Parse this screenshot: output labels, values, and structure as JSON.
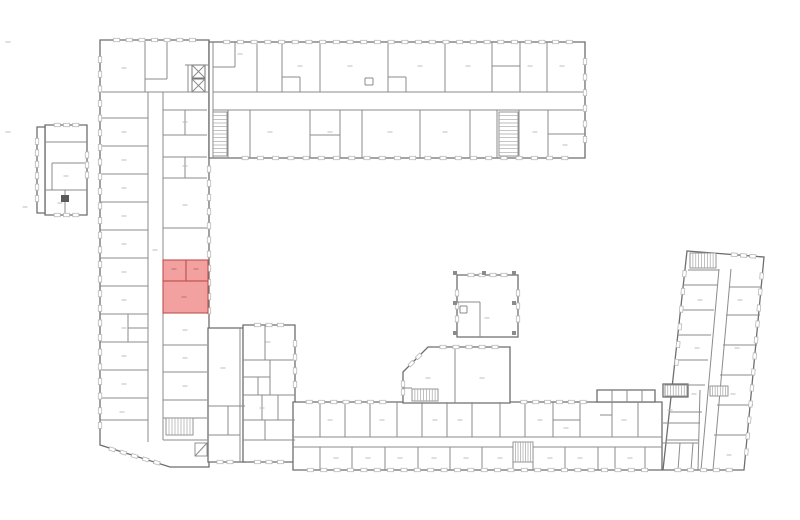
{
  "meta": {
    "title": "building-floor-plan",
    "canvas": {
      "w": 800,
      "h": 520,
      "bg": "#ffffff"
    }
  },
  "style": {
    "wall_color": "#8b8b8b",
    "outline_color": "#6e6e6e",
    "window_color": "#b9b9b9",
    "highlight_fill": "#f2a0a0",
    "highlight_stroke": "#c0504d",
    "highlight_mark": "#bb6f6f",
    "micro_label_color": "#bcbcbc"
  },
  "plan": {
    "outlines": [
      {
        "name": "left-wing",
        "points": "100,40 209,40 209,467 170,467 100,445"
      },
      {
        "name": "corner-block",
        "points": "208,328 245,328 245,462 208,462"
      },
      {
        "name": "south-annex",
        "points": "243,325 295,325 295,462 243,462"
      },
      {
        "name": "top-wing",
        "points": "209,42 585,42 585,158 209,158"
      },
      {
        "name": "bottom-wing",
        "points": "293,402 662,402 662,470 293,470"
      },
      {
        "name": "bottom-wing-roof-row",
        "points": "597,390 655,390 655,402 597,402"
      },
      {
        "name": "courtyard-pavilion",
        "points": "457,275 518,275 518,337 457,337"
      },
      {
        "name": "courtyard-mid-block",
        "points": "403,372 428,347 510,347 510,403 403,403"
      },
      {
        "name": "right-wing",
        "points": "687,251 764,257 744,470 663,470"
      },
      {
        "name": "right-wing-protrusion",
        "points": "663,384 688,384 688,397 663,397"
      },
      {
        "name": "detached-building-main",
        "points": "45,125 87,125 87,215 45,215"
      },
      {
        "name": "detached-building-strip",
        "points": "37,127 45,127 45,213 37,213"
      }
    ],
    "walls": [
      [
        148,
        92,
        148,
        442
      ],
      [
        163,
        92,
        163,
        440
      ],
      [
        100,
        92,
        209,
        92
      ],
      [
        145,
        41,
        145,
        92
      ],
      [
        167,
        41,
        167,
        79
      ],
      [
        145,
        79,
        167,
        79
      ],
      [
        185,
        65,
        209,
        65
      ],
      [
        188,
        65,
        188,
        92
      ],
      [
        100,
        118,
        148,
        118
      ],
      [
        100,
        146,
        148,
        146
      ],
      [
        100,
        174,
        148,
        174
      ],
      [
        100,
        202,
        148,
        202
      ],
      [
        100,
        230,
        148,
        230
      ],
      [
        100,
        258,
        148,
        258
      ],
      [
        100,
        286,
        148,
        286
      ],
      [
        100,
        314,
        148,
        314
      ],
      [
        100,
        342,
        148,
        342
      ],
      [
        100,
        370,
        148,
        370
      ],
      [
        100,
        398,
        148,
        398
      ],
      [
        100,
        420,
        148,
        420
      ],
      [
        128,
        314,
        128,
        342
      ],
      [
        128,
        328,
        148,
        328
      ],
      [
        163,
        110,
        207,
        110
      ],
      [
        163,
        135,
        207,
        135
      ],
      [
        163,
        157,
        207,
        157
      ],
      [
        163,
        178,
        207,
        178
      ],
      [
        163,
        228,
        207,
        228
      ],
      [
        163,
        345,
        207,
        345
      ],
      [
        163,
        372,
        207,
        372
      ],
      [
        163,
        400,
        207,
        400
      ],
      [
        163,
        418,
        207,
        418
      ],
      [
        163,
        440,
        207,
        440
      ],
      [
        185,
        110,
        185,
        135
      ],
      [
        185,
        157,
        185,
        178
      ],
      [
        208,
        406,
        245,
        406
      ],
      [
        240,
        328,
        240,
        462
      ],
      [
        208,
        435,
        240,
        435
      ],
      [
        228,
        406,
        228,
        435
      ],
      [
        243,
        360,
        295,
        360
      ],
      [
        265,
        325,
        265,
        360
      ],
      [
        243,
        377,
        270,
        377
      ],
      [
        270,
        360,
        270,
        395
      ],
      [
        243,
        395,
        295,
        395
      ],
      [
        258,
        377,
        258,
        395
      ],
      [
        243,
        420,
        295,
        420
      ],
      [
        262,
        395,
        262,
        420
      ],
      [
        278,
        395,
        278,
        420
      ],
      [
        243,
        440,
        295,
        440
      ],
      [
        265,
        420,
        265,
        440
      ],
      [
        213,
        92,
        585,
        92
      ],
      [
        213,
        110,
        585,
        110
      ],
      [
        213,
        42,
        213,
        158
      ],
      [
        235,
        42,
        235,
        67
      ],
      [
        213,
        67,
        235,
        67
      ],
      [
        257,
        42,
        257,
        92
      ],
      [
        282,
        42,
        282,
        92
      ],
      [
        320,
        42,
        320,
        92
      ],
      [
        388,
        42,
        388,
        92
      ],
      [
        445,
        42,
        445,
        92
      ],
      [
        492,
        42,
        492,
        92
      ],
      [
        520,
        42,
        520,
        92
      ],
      [
        547,
        42,
        547,
        92
      ],
      [
        282,
        77,
        300,
        77
      ],
      [
        300,
        77,
        300,
        92
      ],
      [
        388,
        77,
        406,
        77
      ],
      [
        406,
        77,
        406,
        92
      ],
      [
        365,
        78,
        373,
        78
      ],
      [
        365,
        78,
        365,
        85
      ],
      [
        365,
        85,
        373,
        85
      ],
      [
        373,
        78,
        373,
        85
      ],
      [
        492,
        66,
        520,
        66
      ],
      [
        228,
        110,
        228,
        158
      ],
      [
        250,
        110,
        250,
        158
      ],
      [
        310,
        110,
        310,
        158
      ],
      [
        340,
        110,
        340,
        158
      ],
      [
        362,
        110,
        362,
        158
      ],
      [
        420,
        110,
        420,
        158
      ],
      [
        470,
        110,
        470,
        158
      ],
      [
        497,
        110,
        497,
        158
      ],
      [
        519,
        110,
        519,
        158
      ],
      [
        548,
        110,
        548,
        158
      ],
      [
        310,
        135,
        340,
        135
      ],
      [
        548,
        134,
        585,
        134
      ],
      [
        293,
        437,
        662,
        437
      ],
      [
        293,
        447,
        662,
        447
      ],
      [
        320,
        402,
        320,
        437
      ],
      [
        345,
        402,
        345,
        437
      ],
      [
        370,
        402,
        370,
        437
      ],
      [
        397,
        402,
        397,
        437
      ],
      [
        422,
        402,
        422,
        437
      ],
      [
        447,
        402,
        447,
        437
      ],
      [
        472,
        402,
        472,
        437
      ],
      [
        500,
        402,
        500,
        437
      ],
      [
        525,
        402,
        525,
        437
      ],
      [
        553,
        402,
        553,
        437
      ],
      [
        580,
        402,
        580,
        437
      ],
      [
        612,
        402,
        612,
        437
      ],
      [
        638,
        402,
        638,
        437
      ],
      [
        553,
        420,
        580,
        420
      ],
      [
        600,
        415,
        612,
        415
      ],
      [
        320,
        447,
        320,
        470
      ],
      [
        352,
        447,
        352,
        470
      ],
      [
        385,
        447,
        385,
        470
      ],
      [
        418,
        447,
        418,
        470
      ],
      [
        450,
        447,
        450,
        470
      ],
      [
        482,
        447,
        482,
        470
      ],
      [
        513,
        447,
        513,
        470
      ],
      [
        533,
        447,
        533,
        470
      ],
      [
        565,
        447,
        565,
        470
      ],
      [
        598,
        447,
        598,
        470
      ],
      [
        615,
        447,
        615,
        470
      ],
      [
        645,
        447,
        645,
        470
      ],
      [
        612,
        390,
        612,
        402
      ],
      [
        627,
        390,
        627,
        402
      ],
      [
        642,
        390,
        642,
        402
      ],
      [
        480,
        302,
        480,
        337
      ],
      [
        457,
        302,
        480,
        302
      ],
      [
        460,
        306,
        467,
        306
      ],
      [
        467,
        306,
        467,
        313
      ],
      [
        460,
        313,
        467,
        313
      ],
      [
        460,
        306,
        460,
        313
      ],
      [
        455,
        347,
        455,
        403
      ],
      [
        403,
        388,
        412,
        388
      ],
      [
        719,
        269,
        701,
        470
      ],
      [
        731,
        269,
        713,
        470
      ],
      [
        688,
        270,
        719,
        270
      ],
      [
        683,
        285,
        717,
        285
      ],
      [
        681,
        310,
        714,
        310
      ],
      [
        678,
        335,
        711,
        335
      ],
      [
        675,
        360,
        708,
        360
      ],
      [
        672,
        385,
        705,
        385
      ],
      [
        669,
        412,
        702,
        412
      ],
      [
        666,
        440,
        699,
        440
      ],
      [
        729,
        287,
        762,
        287
      ],
      [
        726,
        315,
        760,
        315
      ],
      [
        723,
        345,
        757,
        345
      ],
      [
        720,
        375,
        755,
        375
      ],
      [
        717,
        405,
        753,
        405
      ],
      [
        714,
        435,
        750,
        435
      ],
      [
        700,
        390,
        698,
        470
      ],
      [
        663,
        423,
        700,
        423
      ],
      [
        662,
        443,
        698,
        443
      ],
      [
        680,
        443,
        678,
        470
      ],
      [
        693,
        443,
        691,
        470
      ],
      [
        45,
        142,
        87,
        142
      ],
      [
        52,
        163,
        87,
        163
      ],
      [
        52,
        163,
        52,
        190
      ],
      [
        45,
        190,
        87,
        190
      ],
      [
        65,
        190,
        65,
        215
      ]
    ],
    "windows": [
      [
        100,
        45,
        100,
        440,
        26
      ],
      [
        101,
        446,
        168,
        466,
        5
      ],
      [
        209,
        155,
        209,
        325,
        11
      ],
      [
        104,
        40,
        205,
        40,
        7
      ],
      [
        213,
        42,
        583,
        42,
        26
      ],
      [
        230,
        158,
        580,
        158,
        22
      ],
      [
        585,
        46,
        585,
        155,
        6
      ],
      [
        297,
        470,
        658,
        470,
        26
      ],
      [
        297,
        402,
        395,
        402,
        7
      ],
      [
        512,
        402,
        595,
        402,
        6
      ],
      [
        246,
        325,
        292,
        325,
        3
      ],
      [
        295,
        330,
        295,
        398,
        4
      ],
      [
        246,
        462,
        292,
        462,
        3
      ],
      [
        210,
        462,
        240,
        462,
        2
      ],
      [
        460,
        275,
        515,
        275,
        4
      ],
      [
        457,
        280,
        457,
        332,
        3
      ],
      [
        518,
        280,
        518,
        332,
        3
      ],
      [
        430,
        347,
        508,
        347,
        5
      ],
      [
        404,
        371,
        426,
        349,
        2
      ],
      [
        403,
        376,
        403,
        400,
        2
      ],
      [
        763,
        260,
        745,
        468,
        12
      ],
      [
        686,
        256,
        675,
        380,
        6
      ],
      [
        665,
        470,
        742,
        470,
        5
      ],
      [
        725,
        254,
        762,
        257,
        3
      ],
      [
        37,
        130,
        37,
        210,
        6
      ],
      [
        48,
        125,
        85,
        125,
        3
      ],
      [
        48,
        215,
        85,
        215,
        3
      ],
      [
        87,
        145,
        87,
        185,
        3
      ]
    ],
    "stairs": [
      [
        213,
        112,
        14,
        44,
        "h",
        11
      ],
      [
        499,
        112,
        19,
        44,
        "h",
        11
      ],
      [
        166,
        418,
        27,
        17,
        "v",
        8
      ],
      [
        513,
        442,
        20,
        20,
        "v",
        7
      ],
      [
        690,
        253,
        26,
        15,
        "v",
        8
      ],
      [
        665,
        385,
        22,
        11,
        "v",
        7
      ],
      [
        412,
        389,
        26,
        12,
        "v",
        8
      ],
      [
        710,
        386,
        18,
        10,
        "v",
        6
      ],
      [
        195,
        443,
        12,
        13,
        "d",
        0
      ]
    ],
    "elevators": [
      [
        192,
        65,
        13,
        13
      ],
      [
        192,
        79,
        13,
        13
      ]
    ],
    "pillars": [
      [
        455,
        273
      ],
      [
        484,
        273
      ],
      [
        514,
        273
      ],
      [
        455,
        303
      ],
      [
        514,
        303
      ],
      [
        455,
        333
      ],
      [
        514,
        333
      ]
    ],
    "solids": [
      [
        61,
        195,
        8,
        7
      ]
    ],
    "micro_labels": [
      [
        124,
        68
      ],
      [
        124,
        132
      ],
      [
        124,
        160
      ],
      [
        124,
        188
      ],
      [
        124,
        216
      ],
      [
        124,
        244
      ],
      [
        124,
        272
      ],
      [
        124,
        300
      ],
      [
        124,
        328
      ],
      [
        124,
        356
      ],
      [
        124,
        384
      ],
      [
        185,
        122
      ],
      [
        185,
        166
      ],
      [
        185,
        205
      ],
      [
        185,
        330
      ],
      [
        185,
        358
      ],
      [
        185,
        386
      ],
      [
        155,
        250
      ],
      [
        223,
        368
      ],
      [
        268,
        342
      ],
      [
        262,
        408
      ],
      [
        240,
        54
      ],
      [
        300,
        66
      ],
      [
        350,
        66
      ],
      [
        420,
        66
      ],
      [
        468,
        66
      ],
      [
        530,
        66
      ],
      [
        562,
        66
      ],
      [
        270,
        132
      ],
      [
        330,
        132
      ],
      [
        390,
        132
      ],
      [
        445,
        132
      ],
      [
        535,
        132
      ],
      [
        565,
        145
      ],
      [
        330,
        420
      ],
      [
        382,
        420
      ],
      [
        435,
        420
      ],
      [
        460,
        420
      ],
      [
        540,
        420
      ],
      [
        566,
        428
      ],
      [
        624,
        420
      ],
      [
        336,
        458
      ],
      [
        368,
        458
      ],
      [
        400,
        458
      ],
      [
        434,
        458
      ],
      [
        466,
        458
      ],
      [
        500,
        458
      ],
      [
        550,
        458
      ],
      [
        580,
        458
      ],
      [
        630,
        458
      ],
      [
        487,
        318
      ],
      [
        428,
        378
      ],
      [
        482,
        378
      ],
      [
        700,
        300
      ],
      [
        697,
        348
      ],
      [
        694,
        394
      ],
      [
        740,
        300
      ],
      [
        737,
        348
      ],
      [
        733,
        394
      ],
      [
        729,
        455
      ],
      [
        66,
        176
      ],
      [
        60,
        203
      ],
      [
        8,
        42
      ],
      [
        8,
        132
      ],
      [
        25,
        207
      ],
      [
        670,
        410
      ],
      [
        122,
        412
      ]
    ],
    "highlight": {
      "rooms": [
        [
          163,
          260,
          23,
          21
        ],
        [
          186,
          260,
          22,
          21
        ],
        [
          163,
          281,
          45,
          32
        ]
      ],
      "labels": [
        [
          174,
          269
        ],
        [
          196,
          269
        ],
        [
          184,
          297
        ]
      ]
    }
  }
}
